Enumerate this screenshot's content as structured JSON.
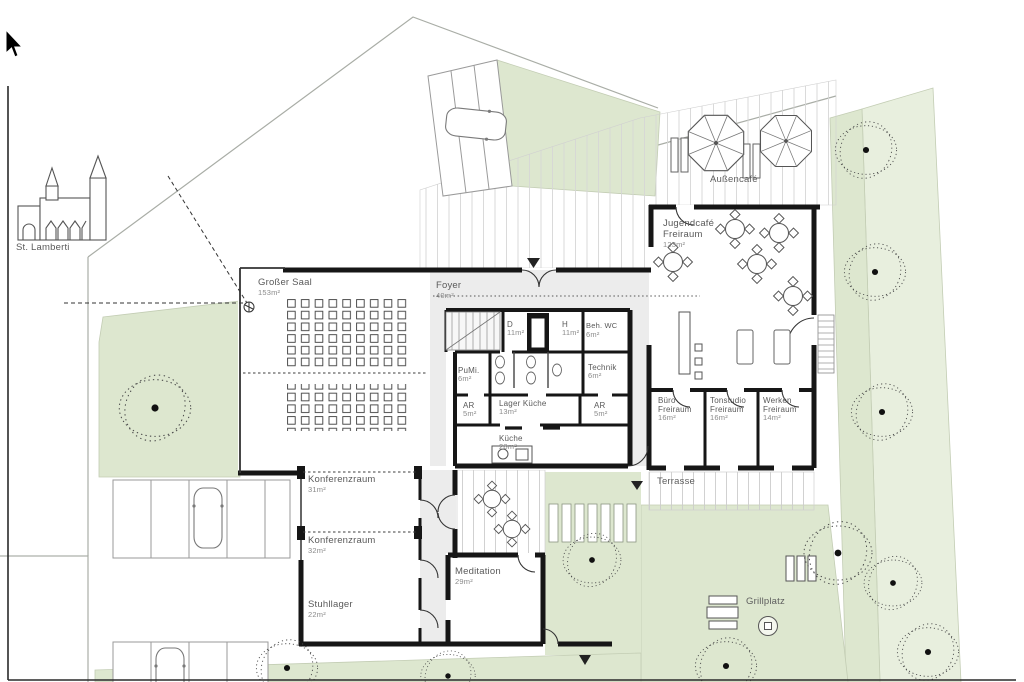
{
  "meta": {
    "title": "Erdgeschoss Lageplan Gemeindezentrum"
  },
  "colors": {
    "green": "#dde7cf",
    "green_light": "#e8efde",
    "wall": "#161616",
    "circulation": "#ececec",
    "label": "#5a5a5a",
    "area_label": "#8a8a8a"
  },
  "site": {
    "church_label": "St. Lamberti",
    "aussencafe": "Außencafé",
    "terrasse": "Terrasse",
    "grillplatz": "Grillplatz"
  },
  "rooms": {
    "grosser_saal": {
      "name": "Großer Saal",
      "area": "153m²"
    },
    "foyer": {
      "name": "Foyer",
      "area": "40m²"
    },
    "wc_d": {
      "name": "D",
      "area": "11m²"
    },
    "wc_h": {
      "name": "H",
      "area": "11m²"
    },
    "beh_wc": {
      "name": "Beh. WC",
      "area": "6m²"
    },
    "pumi": {
      "name": "PuMi.",
      "area": "6m²"
    },
    "technik": {
      "name": "Technik",
      "area": "6m²"
    },
    "ar_left": {
      "name": "AR",
      "area": "5m²"
    },
    "lager_kueche": {
      "name": "Lager Küche",
      "area": "13m²"
    },
    "ar_right": {
      "name": "AR",
      "area": "5m²"
    },
    "kueche": {
      "name": "Küche",
      "area": "28m²"
    },
    "jugendcafe": {
      "name": "Jugendcafé Freiraum",
      "area": "123m²"
    },
    "buero": {
      "name": "Büro Freiraum",
      "area": "16m²"
    },
    "tonstudio": {
      "name": "Tonstudio Freiraum",
      "area": "16m²"
    },
    "werken": {
      "name": "Werken Freiraum",
      "area": "14m²"
    },
    "konferenz1": {
      "name": "Konferenzraum",
      "area": "31m²"
    },
    "konferenz2": {
      "name": "Konferenzraum",
      "area": "32m²"
    },
    "stuhllager": {
      "name": "Stuhllager",
      "area": "22m²"
    },
    "meditation": {
      "name": "Meditation",
      "area": "29m²"
    }
  }
}
